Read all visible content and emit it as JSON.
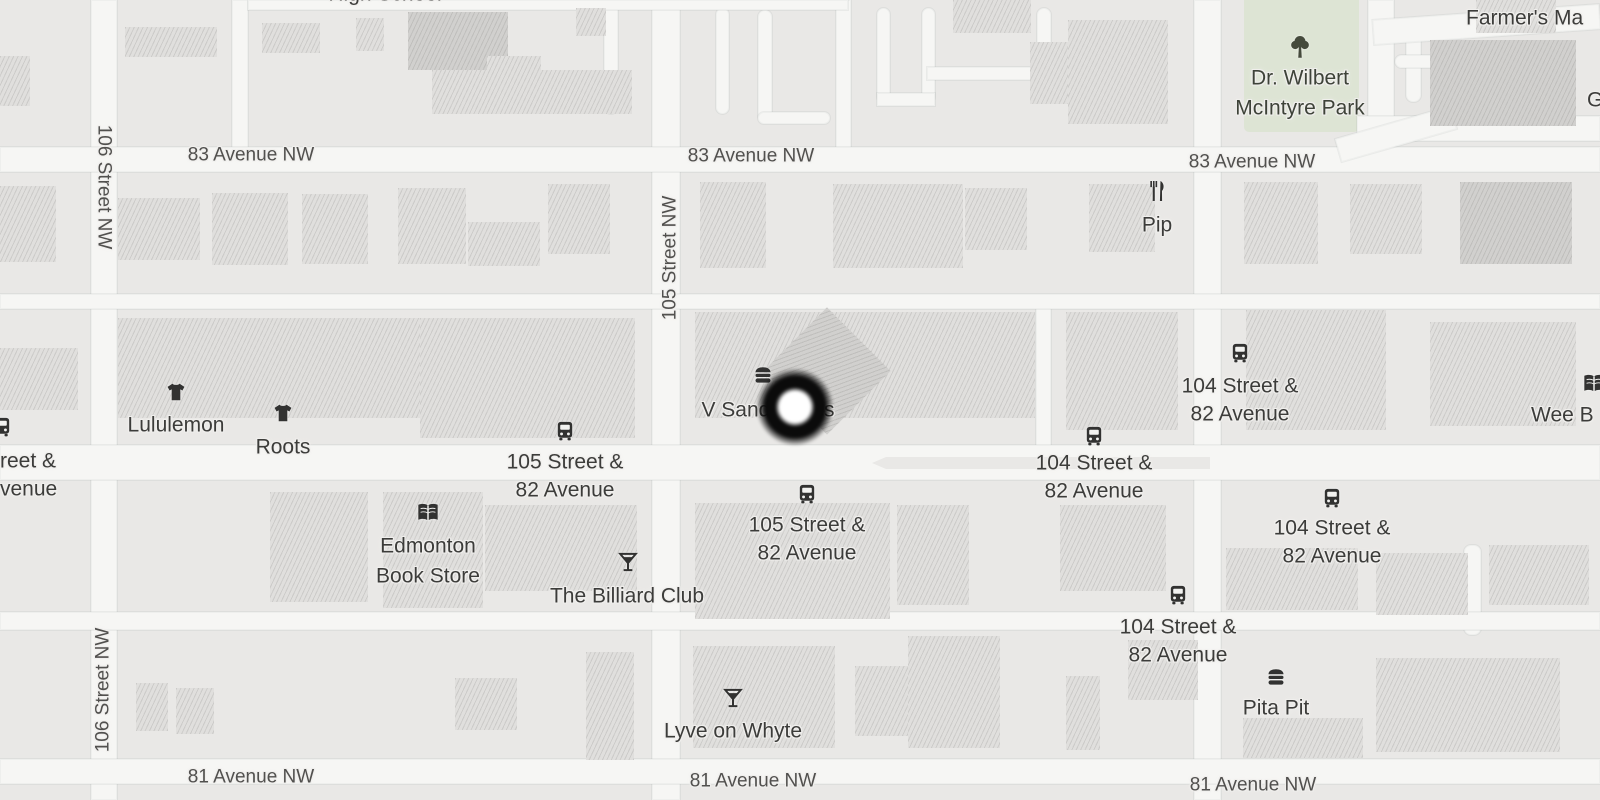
{
  "colors": {
    "background": "#e9e8e6",
    "road": "#f6f6f4",
    "building": "#e0dfdd",
    "building_dark": "#d1d0ce",
    "park": "#dde4d4",
    "poi_text": "#3c3c3a",
    "street_text": "#51504e",
    "marker_ring": "#0b0b0b",
    "marker_core": "#ffffff"
  },
  "park": {
    "x": 1244,
    "y": 0,
    "w": 115,
    "h": 132,
    "icon": "tree",
    "icon_x": 1300,
    "icon_y": 47,
    "lines": [
      "Dr. Wilbert",
      "McIntyre Park"
    ],
    "label_x": 1300,
    "label_y": 78,
    "line_h": 30
  },
  "marker": {
    "x": 795,
    "y": 407
  },
  "roads": {
    "vertical": [
      {
        "x": 91,
        "y": 0,
        "w": 26,
        "h": 800
      },
      {
        "x": 652,
        "y": 0,
        "w": 28,
        "h": 800
      },
      {
        "x": 1194,
        "y": 0,
        "w": 27,
        "h": 800
      },
      {
        "x": 232,
        "y": 0,
        "w": 16,
        "h": 158
      },
      {
        "x": 604,
        "y": 0,
        "w": 14,
        "h": 114,
        "round": true
      },
      {
        "x": 716,
        "y": 8,
        "w": 13,
        "h": 106,
        "round": true
      },
      {
        "x": 758,
        "y": 10,
        "w": 14,
        "h": 112,
        "round": true
      },
      {
        "x": 836,
        "y": 0,
        "w": 15,
        "h": 150
      },
      {
        "x": 877,
        "y": 8,
        "w": 13,
        "h": 95,
        "round": true
      },
      {
        "x": 922,
        "y": 8,
        "w": 13,
        "h": 95,
        "round": true
      },
      {
        "x": 1037,
        "y": 8,
        "w": 14,
        "h": 94,
        "round": true
      },
      {
        "x": 1368,
        "y": 0,
        "w": 26,
        "h": 140
      },
      {
        "x": 1406,
        "y": 30,
        "w": 15,
        "h": 72,
        "round": true
      },
      {
        "x": 1543,
        "y": 55,
        "w": 14,
        "h": 52,
        "round": true
      },
      {
        "x": 1036,
        "y": 300,
        "w": 15,
        "h": 150
      },
      {
        "x": 1464,
        "y": 545,
        "w": 17,
        "h": 90,
        "round": true
      }
    ],
    "horizontal": [
      {
        "x": 248,
        "y": 0,
        "w": 600,
        "h": 10
      },
      {
        "x": 0,
        "y": 147,
        "w": 1600,
        "h": 25
      },
      {
        "x": 1357,
        "y": 116,
        "w": 243,
        "h": 25
      },
      {
        "x": 1336,
        "y": 122,
        "w": 120,
        "h": 24,
        "rot": -16
      },
      {
        "x": 1373,
        "y": 12,
        "w": 227,
        "h": 25,
        "rot": -4
      },
      {
        "x": 1395,
        "y": 55,
        "w": 165,
        "h": 13,
        "round": true
      },
      {
        "x": 927,
        "y": 67,
        "w": 112,
        "h": 13
      },
      {
        "x": 877,
        "y": 93,
        "w": 58,
        "h": 13
      },
      {
        "x": 758,
        "y": 112,
        "w": 72,
        "h": 12,
        "round": true
      },
      {
        "x": 0,
        "y": 294,
        "w": 1600,
        "h": 15
      },
      {
        "x": 0,
        "y": 445,
        "w": 1600,
        "h": 35
      },
      {
        "x": 0,
        "y": 612,
        "w": 1600,
        "h": 18
      },
      {
        "x": 0,
        "y": 759,
        "w": 1600,
        "h": 25
      }
    ]
  },
  "median": {
    "x": 872,
    "y": 457,
    "w": 338,
    "h": 12
  },
  "buildings": [
    {
      "x": 0,
      "y": 56,
      "w": 30,
      "h": 50
    },
    {
      "x": 125,
      "y": 27,
      "w": 92,
      "h": 30
    },
    {
      "x": 262,
      "y": 23,
      "w": 58,
      "h": 30
    },
    {
      "x": 356,
      "y": 18,
      "w": 28,
      "h": 33
    },
    {
      "x": 408,
      "y": 12,
      "w": 100,
      "h": 58,
      "d": true
    },
    {
      "x": 432,
      "y": 70,
      "w": 200,
      "h": 44
    },
    {
      "x": 487,
      "y": 56,
      "w": 54,
      "h": 58
    },
    {
      "x": 576,
      "y": 8,
      "w": 30,
      "h": 28
    },
    {
      "x": 953,
      "y": 0,
      "w": 78,
      "h": 33
    },
    {
      "x": 1030,
      "y": 42,
      "w": 62,
      "h": 62
    },
    {
      "x": 1068,
      "y": 20,
      "w": 100,
      "h": 104
    },
    {
      "x": 1430,
      "y": 40,
      "w": 146,
      "h": 86,
      "d": true
    },
    {
      "x": 1476,
      "y": 0,
      "w": 80,
      "h": 33
    },
    {
      "x": 0,
      "y": 186,
      "w": 56,
      "h": 76
    },
    {
      "x": 118,
      "y": 198,
      "w": 82,
      "h": 62
    },
    {
      "x": 212,
      "y": 193,
      "w": 76,
      "h": 72
    },
    {
      "x": 302,
      "y": 194,
      "w": 66,
      "h": 70
    },
    {
      "x": 398,
      "y": 188,
      "w": 68,
      "h": 76
    },
    {
      "x": 468,
      "y": 222,
      "w": 72,
      "h": 44
    },
    {
      "x": 548,
      "y": 184,
      "w": 62,
      "h": 70
    },
    {
      "x": 700,
      "y": 182,
      "w": 66,
      "h": 86
    },
    {
      "x": 833,
      "y": 184,
      "w": 130,
      "h": 84
    },
    {
      "x": 965,
      "y": 188,
      "w": 62,
      "h": 62
    },
    {
      "x": 1089,
      "y": 184,
      "w": 66,
      "h": 68
    },
    {
      "x": 1244,
      "y": 182,
      "w": 74,
      "h": 82
    },
    {
      "x": 1350,
      "y": 184,
      "w": 72,
      "h": 70
    },
    {
      "x": 1460,
      "y": 182,
      "w": 112,
      "h": 82,
      "d": true
    },
    {
      "x": 0,
      "y": 348,
      "w": 78,
      "h": 62
    },
    {
      "x": 118,
      "y": 318,
      "w": 385,
      "h": 100
    },
    {
      "x": 420,
      "y": 318,
      "w": 215,
      "h": 120
    },
    {
      "x": 695,
      "y": 312,
      "w": 340,
      "h": 106
    },
    {
      "x": 782,
      "y": 326,
      "w": 90,
      "h": 90,
      "d": true,
      "rot": 45
    },
    {
      "x": 1066,
      "y": 312,
      "w": 112,
      "h": 118
    },
    {
      "x": 1246,
      "y": 310,
      "w": 140,
      "h": 120
    },
    {
      "x": 1430,
      "y": 322,
      "w": 146,
      "h": 104
    },
    {
      "x": 270,
      "y": 492,
      "w": 98,
      "h": 110
    },
    {
      "x": 383,
      "y": 492,
      "w": 100,
      "h": 116
    },
    {
      "x": 485,
      "y": 505,
      "w": 152,
      "h": 86
    },
    {
      "x": 695,
      "y": 503,
      "w": 195,
      "h": 116
    },
    {
      "x": 897,
      "y": 505,
      "w": 72,
      "h": 100
    },
    {
      "x": 1060,
      "y": 505,
      "w": 106,
      "h": 86
    },
    {
      "x": 1226,
      "y": 548,
      "w": 132,
      "h": 62
    },
    {
      "x": 1376,
      "y": 553,
      "w": 92,
      "h": 62
    },
    {
      "x": 1489,
      "y": 545,
      "w": 100,
      "h": 60
    },
    {
      "x": 136,
      "y": 683,
      "w": 32,
      "h": 48
    },
    {
      "x": 176,
      "y": 688,
      "w": 38,
      "h": 46
    },
    {
      "x": 455,
      "y": 678,
      "w": 62,
      "h": 52
    },
    {
      "x": 586,
      "y": 652,
      "w": 48,
      "h": 108
    },
    {
      "x": 693,
      "y": 646,
      "w": 142,
      "h": 102
    },
    {
      "x": 855,
      "y": 666,
      "w": 70,
      "h": 70
    },
    {
      "x": 908,
      "y": 636,
      "w": 92,
      "h": 112
    },
    {
      "x": 1066,
      "y": 676,
      "w": 34,
      "h": 74
    },
    {
      "x": 1128,
      "y": 640,
      "w": 70,
      "h": 60
    },
    {
      "x": 1243,
      "y": 718,
      "w": 120,
      "h": 40
    },
    {
      "x": 1376,
      "y": 658,
      "w": 184,
      "h": 94
    }
  ],
  "street_labels": [
    {
      "text": "83 Avenue NW",
      "x": 251,
      "y": 155,
      "rot": 0
    },
    {
      "text": "83 Avenue NW",
      "x": 751,
      "y": 156,
      "rot": 0
    },
    {
      "text": "83 Avenue NW",
      "x": 1252,
      "y": 162,
      "rot": 0
    },
    {
      "text": "81 Avenue NW",
      "x": 251,
      "y": 777,
      "rot": 0
    },
    {
      "text": "81 Avenue NW",
      "x": 753,
      "y": 781,
      "rot": 0
    },
    {
      "text": "81 Avenue NW",
      "x": 1253,
      "y": 785,
      "rot": 0
    },
    {
      "text": "106 Street NW",
      "x": 104,
      "y": 187,
      "rot": 90
    },
    {
      "text": "106 Street NW",
      "x": 103,
      "y": 690,
      "rot": -90
    },
    {
      "text": "105 Street NW",
      "x": 670,
      "y": 258,
      "rot": -90
    }
  ],
  "pois": [
    {
      "name": "High School",
      "lines": [
        "High School"
      ],
      "x": 385,
      "y": -6
    },
    {
      "name": "Farmers Market",
      "lines": [
        "Farmer's Ma"
      ],
      "x": 1466,
      "y": 18,
      "anchor": "left"
    },
    {
      "name": "G",
      "lines": [
        "G"
      ],
      "x": 1587,
      "y": 100,
      "anchor": "left"
    },
    {
      "name": "Pip",
      "icon": "restaurant",
      "icon_y": 191,
      "lines": [
        "Pip"
      ],
      "x": 1157,
      "y": 225
    },
    {
      "name": "Lululemon",
      "icon": "shirt",
      "icon_y": 392,
      "lines": [
        "Lululemon"
      ],
      "x": 176,
      "y": 425
    },
    {
      "name": "Roots",
      "icon": "shirt",
      "icon_y": 413,
      "lines": [
        "Roots"
      ],
      "x": 283,
      "y": 447
    },
    {
      "name": "V Sandwiches",
      "icon": "sandwich",
      "icon_x": 763,
      "icon_y": 375,
      "lines": [
        "V Sandwiches"
      ],
      "x": 768,
      "y": 410
    },
    {
      "name": "Edmonton Book Store",
      "icon": "book",
      "icon_y": 513,
      "lines": [
        "Edmonton",
        "Book Store"
      ],
      "x": 428,
      "y": 546,
      "line_h": 30
    },
    {
      "name": "The Billiard Club",
      "icon": "cocktail",
      "icon_x": 628,
      "icon_y": 562,
      "lines": [
        "The Billiard Club"
      ],
      "x": 627,
      "y": 596
    },
    {
      "name": "Lyve on Whyte",
      "icon": "cocktail",
      "icon_y": 698,
      "lines": [
        "Lyve on Whyte"
      ],
      "x": 733,
      "y": 731
    },
    {
      "name": "Pita Pit",
      "icon": "sandwich",
      "icon_y": 677,
      "lines": [
        "Pita Pit"
      ],
      "x": 1276,
      "y": 708
    },
    {
      "name": "Wee Book",
      "icon": "book",
      "icon_x": 1594,
      "icon_y": 384,
      "lines": [
        "Wee B"
      ],
      "x": 1531,
      "y": 415,
      "anchor": "left"
    }
  ],
  "transit_stops": [
    {
      "lines": [
        "105 Street &",
        "82 Avenue"
      ],
      "x": 565,
      "icon_y": 431,
      "y": 462
    },
    {
      "lines": [
        "105 Street &",
        "82 Avenue"
      ],
      "x": 807,
      "icon_y": 494,
      "y": 525
    },
    {
      "lines": [
        "104 Street &",
        "82 Avenue"
      ],
      "x": 1240,
      "icon_y": 353,
      "y": 386
    },
    {
      "lines": [
        "104 Street &",
        "82 Avenue"
      ],
      "x": 1094,
      "icon_y": 436,
      "y": 463
    },
    {
      "lines": [
        "104 Street &",
        "82 Avenue"
      ],
      "x": 1332,
      "icon_y": 498,
      "y": 528
    },
    {
      "lines": [
        "104 Street &",
        "82 Avenue"
      ],
      "x": 1178,
      "icon_y": 595,
      "y": 627
    },
    {
      "lines": [
        "reet &",
        "venue"
      ],
      "x": 0,
      "icon_x": 2,
      "icon_y": 427,
      "y": 461,
      "anchor": "left"
    }
  ]
}
